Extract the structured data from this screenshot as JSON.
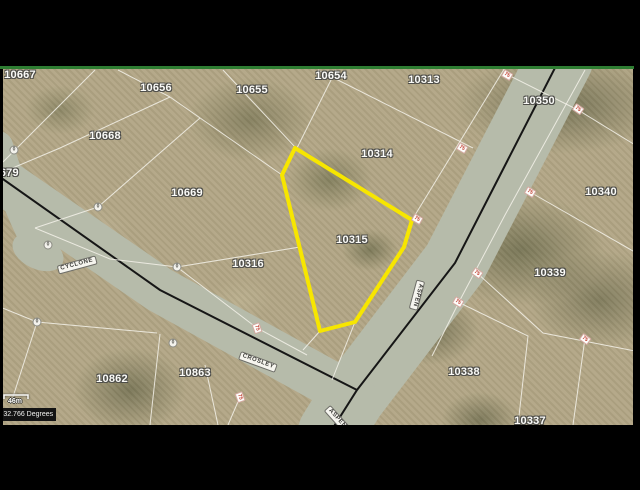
{
  "frame": {
    "background_color": "#000000",
    "top_border_color": "#2e7d32"
  },
  "statusbar": {
    "coordinates": "-32.766 Degrees",
    "scale_label": "46m"
  },
  "map": {
    "type": "aerial-parcel-map",
    "terrain_base_color": "#b2a685",
    "road_fill_color": "#b6bbaa",
    "road_centerline_color": "#161616",
    "parcel_line_color": "#f4f2ea",
    "highlight": {
      "parcel_id": "10315",
      "color": "#f7e600",
      "points": "295,148 412,220 404,247 355,322 320,331 282,175"
    },
    "roads": {
      "strips": [
        {
          "name": "aspen-road",
          "path": "M560,60 L455,263 L352,398 L331,432",
          "width": 66
        },
        {
          "name": "crosley-road",
          "path": "M-8,174 L160,290 L354,397",
          "width": 46
        },
        {
          "name": "west-branch-road",
          "path": "M34,238 C18,205 8,178 -2,146",
          "width": 30
        }
      ],
      "culdesac": {
        "cx": 38,
        "cy": 252,
        "rx": 27,
        "ry": 17,
        "rot": 25
      },
      "centerlines": [
        "M558,62 L455,263 L357,390 L333,428",
        "M0,177 L160,290 L357,390"
      ]
    },
    "boundary_lines": [
      "3,162 95,70",
      "118,70 170,97",
      "170,97 60,148 3,172",
      "170,97 282,175",
      "223,70 295,147",
      "336,70 297,148",
      "318,70 473,148",
      "506,66 412,220",
      "355,322 332,380",
      "200,118 98,207 35,228",
      "177,267 300,247",
      "320,331 303,350",
      "35,228 110,259 177,267",
      "177,267 257,328 307,355",
      "508,75 578,110 640,148",
      "530,192 640,255",
      "585,70 505,215 460,300 432,356",
      "477,273 543,333 640,352",
      "458,302 528,336 518,425",
      "585,338 573,425",
      "0,307 37,322 157,333",
      "160,334 150,425",
      "205,365 218,425",
      "37,322 12,400",
      "240,397 228,425"
    ],
    "parcel_labels": [
      {
        "id": "10667",
        "x": 20,
        "y": 75
      },
      {
        "id": "10656",
        "x": 156,
        "y": 88
      },
      {
        "id": "10655",
        "x": 252,
        "y": 90
      },
      {
        "id": "10654",
        "x": 331,
        "y": 76
      },
      {
        "id": "10313",
        "x": 424,
        "y": 80
      },
      {
        "id": "10350",
        "x": 539,
        "y": 101
      },
      {
        "id": "10668",
        "x": 105,
        "y": 136
      },
      {
        "id": "10314",
        "x": 377,
        "y": 154
      },
      {
        "id": "10340",
        "x": 601,
        "y": 192
      },
      {
        "id": "10679",
        "x": 3,
        "y": 173
      },
      {
        "id": "10669",
        "x": 187,
        "y": 193
      },
      {
        "id": "10315",
        "x": 352,
        "y": 240
      },
      {
        "id": "10316",
        "x": 248,
        "y": 264
      },
      {
        "id": "10339",
        "x": 550,
        "y": 273
      },
      {
        "id": "10338",
        "x": 464,
        "y": 372
      },
      {
        "id": "10862",
        "x": 112,
        "y": 379
      },
      {
        "id": "10863",
        "x": 195,
        "y": 373
      },
      {
        "id": "10337",
        "x": 530,
        "y": 421
      }
    ],
    "street_labels": [
      {
        "name": "CYCLONE",
        "x": 77,
        "y": 265,
        "rot": -15
      },
      {
        "name": "CROSLEY",
        "x": 258,
        "y": 362,
        "rot": 20
      },
      {
        "name": "ASPEN",
        "x": 417,
        "y": 295,
        "rot": 105
      },
      {
        "name": "ASPEN",
        "x": 337,
        "y": 419,
        "rot": 48
      }
    ],
    "dimension_markers": [
      {
        "text": "75",
        "x": 507,
        "y": 75,
        "rot": 30
      },
      {
        "text": "75",
        "x": 578,
        "y": 109,
        "rot": 35
      },
      {
        "text": "75",
        "x": 462,
        "y": 148,
        "rot": 30
      },
      {
        "text": "75",
        "x": 417,
        "y": 219,
        "rot": 30
      },
      {
        "text": "75",
        "x": 530,
        "y": 192,
        "rot": 30
      },
      {
        "text": "75",
        "x": 477,
        "y": 273,
        "rot": 35
      },
      {
        "text": "75",
        "x": 458,
        "y": 302,
        "rot": 30
      },
      {
        "text": "75",
        "x": 257,
        "y": 328,
        "rot": 70
      },
      {
        "text": "75",
        "x": 240,
        "y": 397,
        "rot": 70
      },
      {
        "text": "75",
        "x": 585,
        "y": 339,
        "rot": 35
      }
    ],
    "vertex_markers": [
      {
        "text": "0",
        "x": 14,
        "y": 150
      },
      {
        "text": "0",
        "x": 98,
        "y": 207
      },
      {
        "text": "0",
        "x": 177,
        "y": 267
      },
      {
        "text": "0",
        "x": 48,
        "y": 245
      },
      {
        "text": "0",
        "x": 37,
        "y": 322
      },
      {
        "text": "0",
        "x": 173,
        "y": 343
      }
    ],
    "scalebar": {
      "x1": 4,
      "x2": 28,
      "y": 395
    }
  }
}
